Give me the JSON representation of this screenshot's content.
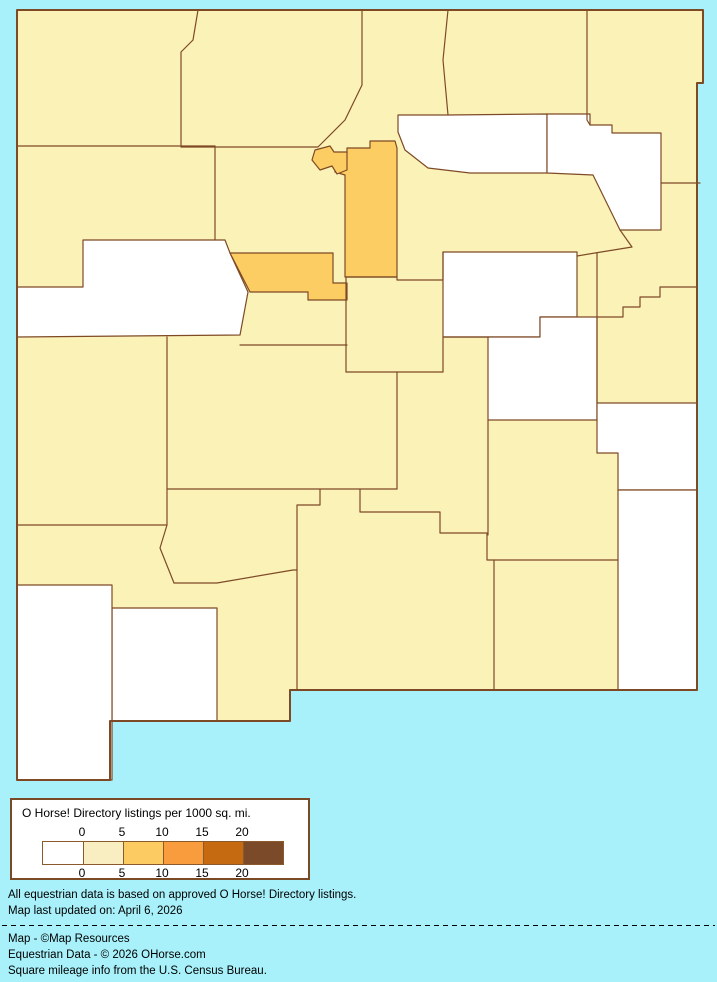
{
  "page": {
    "background": "#a8f1fa"
  },
  "map": {
    "description": "Choropleth map of New Mexico counties shaded by O Horse! Directory listings per 1000 sq. mi.",
    "stroke_color": "#7e4a26",
    "state_fill": "#fbf2b8",
    "value_colors": {
      "0": "#ffffff",
      "0-5": "#fbf2b8",
      "5-10": "#fccd62"
    },
    "state_outline": "17,10 703,10 703,83 697,83 697,690 290,690 290,721 110,721 110,780 17,780",
    "counties": [
      {
        "name": "cibola",
        "bucket": "0",
        "points": "83,240 225,240 230,253 248,292 240,335 17,337 17,287 83,287"
      },
      {
        "name": "mora",
        "bucket": "0",
        "points": "398,115 448,115 547,114 547,173 470,173 428,168 405,150 398,132"
      },
      {
        "name": "harding",
        "bucket": "0",
        "points": "547,114 590,114 590,125 612,125 612,133 661,133 661,230 620,230 593,175 547,173"
      },
      {
        "name": "guadalupe",
        "bucket": "0",
        "points": "443,252 577,252 577,317 540,317 540,337 443,337"
      },
      {
        "name": "de-baca",
        "bucket": "0",
        "points": "488,337 540,337 540,317 597,317 597,420 488,420"
      },
      {
        "name": "roosevelt",
        "bucket": "0",
        "points": "597,403 697,403 697,490 618,490 618,453 597,453"
      },
      {
        "name": "lea",
        "bucket": "0",
        "points": "618,490 697,490 697,690 618,690"
      },
      {
        "name": "luna",
        "bucket": "0",
        "points": "112,608 217,608 217,721 112,721"
      },
      {
        "name": "hidalgo",
        "bucket": "0",
        "points": "17,585 112,585 112,780 17,780"
      },
      {
        "name": "santa-fe",
        "bucket": "5-10",
        "points": "347,148 370,148 370,141 395,141 397,148 397,277 345,277 345,175 335,172 335,153 347,153"
      },
      {
        "name": "los-alamos",
        "bucket": "5-10",
        "points": "315,150 330,146 334,152 347,152 347,170 337,174 332,166 320,170 312,160"
      },
      {
        "name": "bernalillo",
        "bucket": "5-10",
        "points": "230,253 333,253 333,283 347,283 347,300 308,300 308,292 250,292"
      }
    ],
    "border_lines": [
      "198,10 193,40 181,52 181,146",
      "17,146 215,146",
      "215,146 215,240",
      "181,147 318,147 345,120 362,85 362,10",
      "448,10 443,60 448,115",
      "587,10 587,120 590,125",
      "661,183 700,183",
      "620,230 632,247 595,253 577,256",
      "597,253 597,403",
      "697,287 660,287 660,297 640,297 640,307 623,307 623,317 597,317",
      "346,277 346,372",
      "346,277 397,277 397,280 443,280 443,252",
      "240,345 347,345",
      "346,372 443,372 443,337 488,337",
      "397,372 397,489",
      "167,337 167,525 160,548 174,583",
      "17,525 167,525",
      "167,489 397,489",
      "174,583 217,583 293,570 297,570",
      "320,489 320,505 297,505 297,690",
      "360,489 360,512 440,512 440,533 487,533 487,560 494,560 494,690",
      "494,560 618,560",
      "488,420 488,535"
    ]
  },
  "legend": {
    "title": "O Horse! Directory listings per 1000 sq. mi.",
    "ticks_top": [
      "0",
      "5",
      "10",
      "15",
      "20"
    ],
    "ticks_bottom": [
      "0",
      "5",
      "10",
      "15",
      "20"
    ],
    "ramp_colors": [
      "#ffffff",
      "#f8eec2",
      "#fccb61",
      "#f89c3e",
      "#c66a12",
      "#7b4a28"
    ]
  },
  "footnotes": {
    "line1": "All equestrian data is based on approved O Horse! Directory listings.",
    "line2": "Map last updated on: April 6, 2026"
  },
  "credits": {
    "line1": "Map - ©Map Resources",
    "line2": "Equestrian Data - © 2026 OHorse.com",
    "line3": "Square mileage info from the U.S. Census Bureau."
  }
}
